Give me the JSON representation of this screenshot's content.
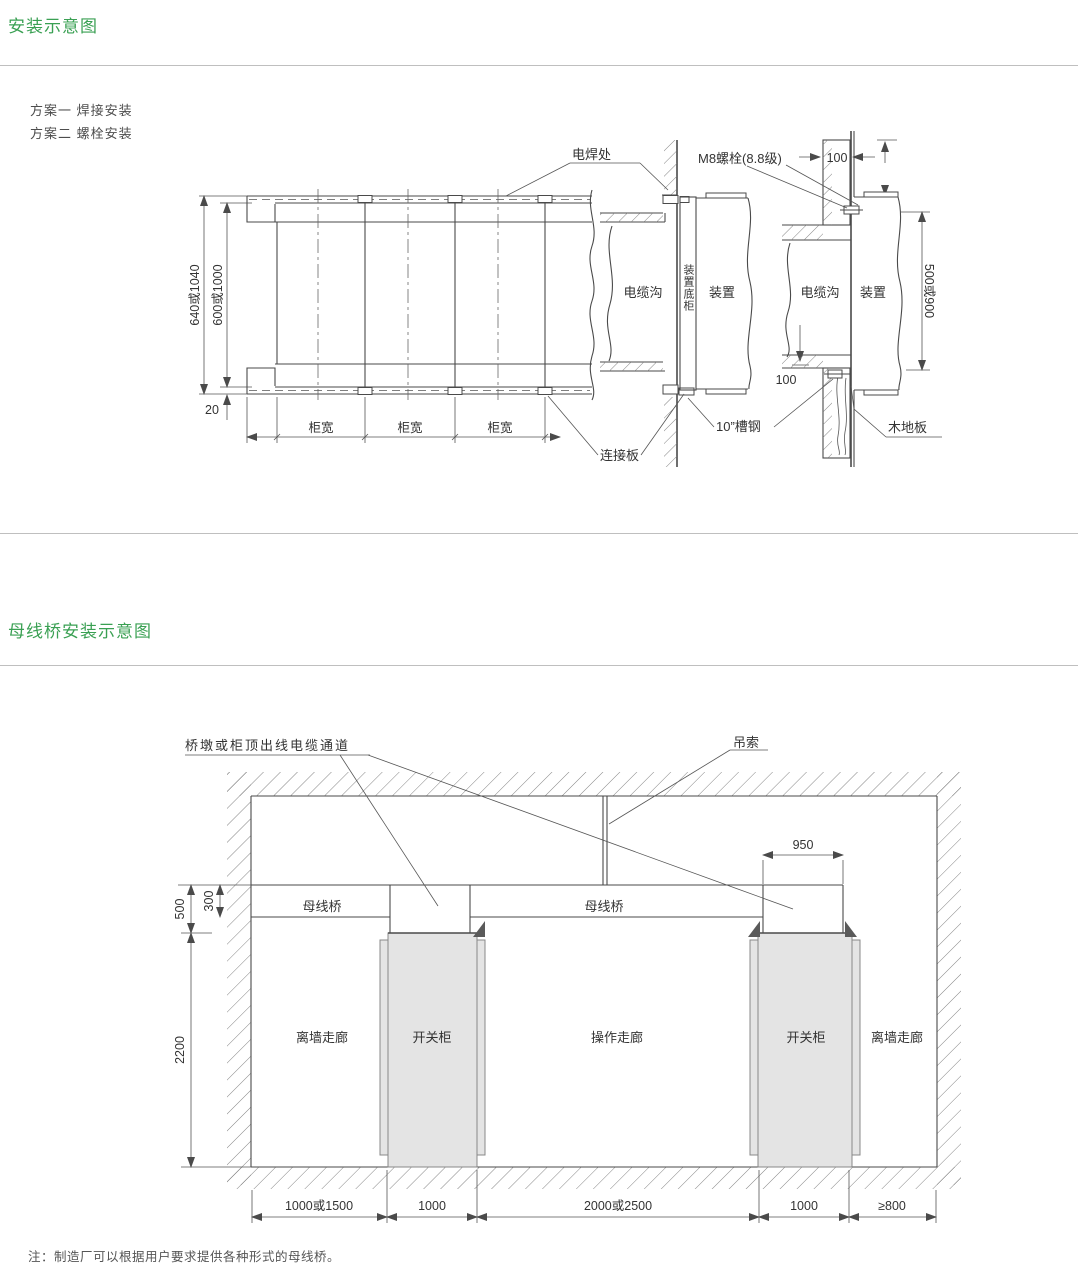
{
  "section1": {
    "title": "安装示意图",
    "scheme1": "方案一  焊接安装",
    "scheme2": "方案二  螺栓安装"
  },
  "diagram1": {
    "weld_label": "电焊处",
    "bolt_label": "M8螺栓(8.8级)",
    "dim_100": "100",
    "cable_trench": "电缆沟",
    "device_bottom_cabinet": "装置底柜",
    "device": "装置",
    "dim_outer": "640或1040",
    "dim_inner": "600或1000",
    "dim_20": "20",
    "cabinet_width": "柜宽",
    "connection_plate": "连接板",
    "channel_label": "10”槽钢",
    "wood_floor": "木地板",
    "dim_side": "500或900"
  },
  "section2": {
    "title": "母线桥安装示意图"
  },
  "diagram2": {
    "cable_channel_label": "桥墩或柜顶出线电缆通道",
    "sling_label": "吊索",
    "dim_950": "950",
    "dim_500": "500",
    "dim_300": "300",
    "dim_2200": "2200",
    "busbar_bridge": "母线桥",
    "wall_corridor": "离墙走廊",
    "switch_cabinet": "开关柜",
    "operation_corridor": "操作走廊",
    "dim_b1": "1000或1500",
    "dim_b2": "1000",
    "dim_b3": "2000或2500",
    "dim_b4": "1000",
    "dim_b5": "≥800"
  },
  "note": "注：制造厂可以根据用户要求提供各种形式的母线桥。"
}
